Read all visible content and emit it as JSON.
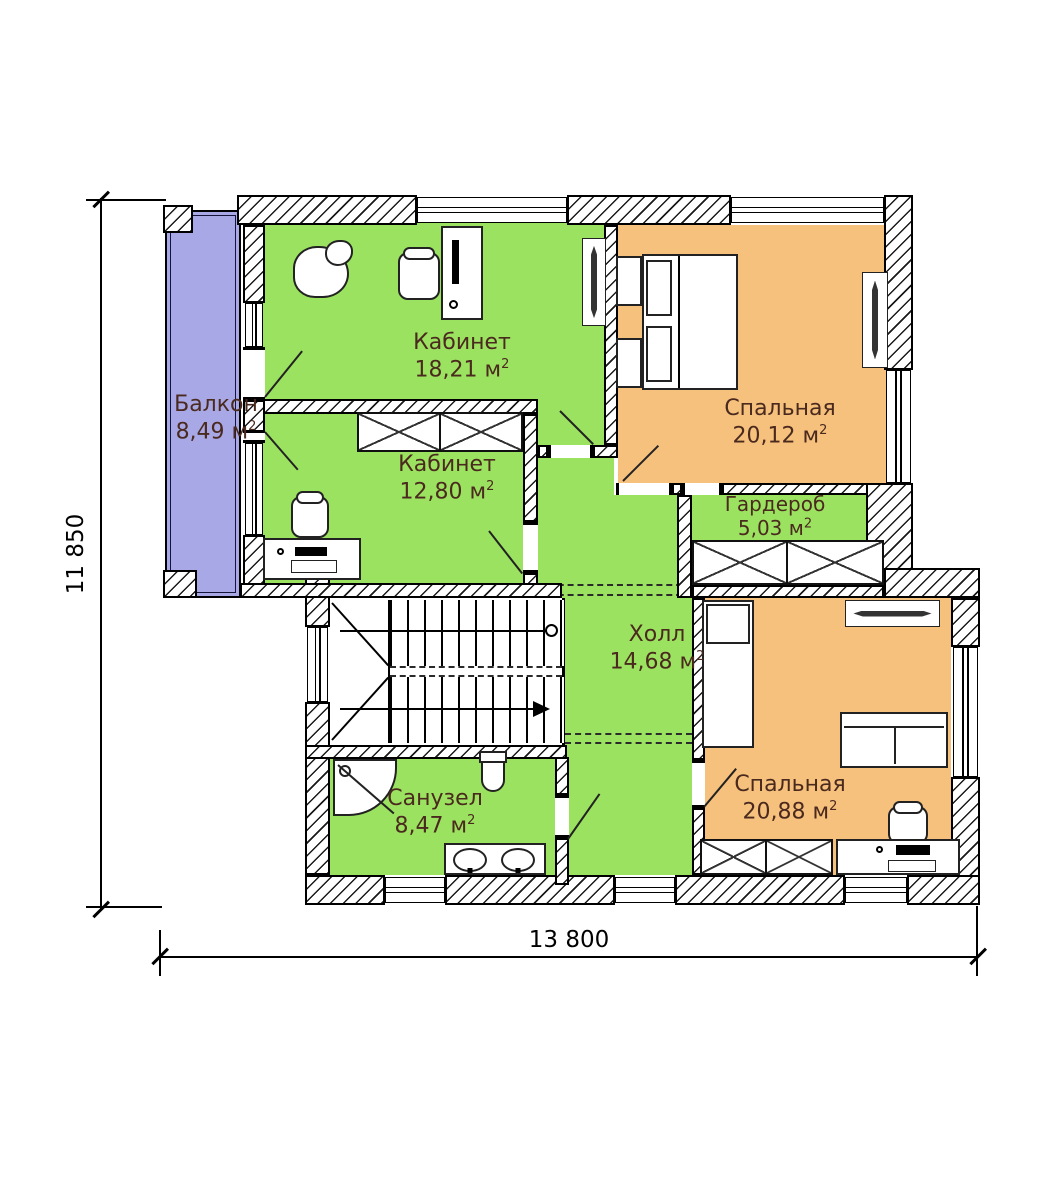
{
  "type": "floor-plan",
  "dimensions": {
    "height_label": "11 850",
    "width_label": "13 800"
  },
  "units": {
    "area_symbol": "м",
    "area_exponent": "2"
  },
  "rooms": [
    {
      "name": "Балкон",
      "area": "8,49"
    },
    {
      "name": "Кабинет",
      "area": "18,21"
    },
    {
      "name": "Спальная",
      "area": "20,12"
    },
    {
      "name": "Кабинет",
      "area": "12,80"
    },
    {
      "name": "Гардероб",
      "area": "5,03"
    },
    {
      "name": "Холл",
      "area": "14,68"
    },
    {
      "name": "Санузел",
      "area": "8,47"
    },
    {
      "name": "Спальная",
      "area": "20,88"
    }
  ],
  "symbols": [
    "double-bed",
    "single-bed",
    "sofa",
    "office-chair",
    "desk",
    "computer",
    "wardrobe",
    "stairs",
    "shower",
    "toilet",
    "double-sink",
    "plant",
    "radiator",
    "door-swing",
    "window"
  ],
  "colors": {
    "room_green": "#9ce261",
    "room_orange": "#f6c07d",
    "balcony_purple": "#a8a8e6",
    "label_text": "#4a2a1e",
    "line": "#000000"
  }
}
